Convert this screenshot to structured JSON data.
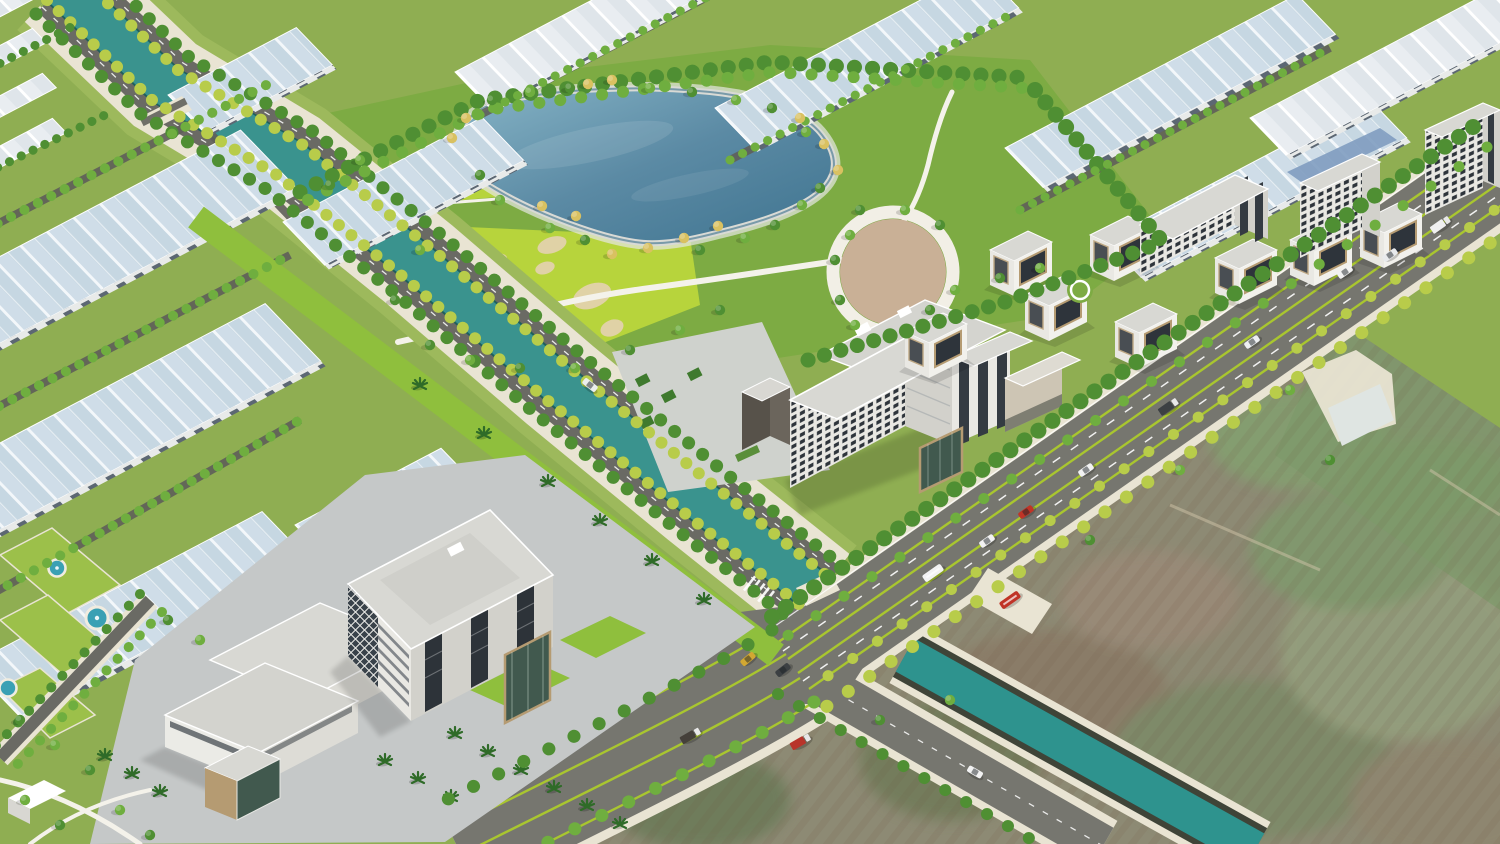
{
  "scene": {
    "title": "Aerial 3D render - industrial park masterplan with canal, lake park and boulevard",
    "type": "architectural-visualization",
    "view": "aerial-oblique",
    "elements": [
      "industrial-warehouse-rows-with-blue-striped-roofs",
      "tree-lined-canal-with-twin-roads",
      "central-lake-park-with-golden-trees",
      "bright-golf-lawn-with-sand-bunkers",
      "tan-circular-plaza",
      "office-slab-buildings-with-window-grids",
      "modern-cube-villas-with-wood-framed-glass",
      "campus-office-complex-with-glass-atrium",
      "multi-lane-boulevard-with-green-medians",
      "road-junction-with-crosswalk",
      "secondary-concrete-canal",
      "undeveloped-satellite-textured-fields",
      "fountain-ponds",
      "vehicles-on-roads"
    ],
    "vehicles": [
      {
        "type": "van",
        "color": "white"
      },
      {
        "type": "car",
        "color": "white"
      },
      {
        "type": "truck",
        "color": "dark"
      },
      {
        "type": "car",
        "color": "red"
      },
      {
        "type": "bus",
        "color": "white"
      },
      {
        "type": "bus",
        "color": "red"
      },
      {
        "type": "taxi",
        "color": "yellow"
      },
      {
        "type": "truck",
        "color": "red"
      }
    ]
  },
  "colors": {
    "base": "#8fae52",
    "parkGrass": "#7dab43",
    "lawnBright": "#b7d43c",
    "treeGreen": "#4f8f33",
    "treeLight": "#6fae3f",
    "treeYellow": "#b8cc4a",
    "treeGold": "#d9c161",
    "palmGreen": "#2f6b28",
    "hedgeGreen": "#3f7a2e",
    "canalWater": "#3a938e",
    "canalEdge": "#1f5f5c",
    "canalGrass": "#9db95c",
    "lakeDeep": "#41748e",
    "lakeLight": "#8fb9c8",
    "lakeRim": "#d9dad5",
    "roadAsphalt": "#76766f",
    "roadInner": "#6a6a64",
    "sidewalk": "#e9e4d3",
    "medianGreen": "#a9c62f",
    "roofBlue": "#c6d7e2",
    "roofBluePanel": "#cfdde8",
    "roofWhite": "#dfe5ea",
    "ridgeWhite": "#f3f7fa",
    "whWall": "#e8eae9",
    "doorDark": "#5c6773",
    "buildingWhite": "#e9e8e3",
    "buildingShade": "#d2d1cb",
    "roofGray": "#d8d8d3",
    "windowDark": "#2e343b",
    "glassGreen": "#41594e",
    "woodTan": "#b59b72",
    "plazaTan": "#c9b096",
    "plazaRing": "#f2efe6",
    "pavingGray": "#c5c8c8",
    "pavingLight": "#cfd2cd",
    "sand": "#e0d2a6",
    "pinkPlaza": "#d6b6bf",
    "fieldBase": "#8d8a74",
    "fieldBrown": "#9a8674",
    "fieldGreen": "#7e9a6b",
    "fieldOlive": "#6b7a58",
    "canal2Water": "#2e938e",
    "canal2Wall": "#3f4438",
    "pondWater": "#3aa0b4",
    "solarPanel": "#7f9cc0",
    "carWhite": "#f2f2f2",
    "carRed": "#c03427",
    "carDark": "#3c4043",
    "carYellow": "#d2a832"
  }
}
